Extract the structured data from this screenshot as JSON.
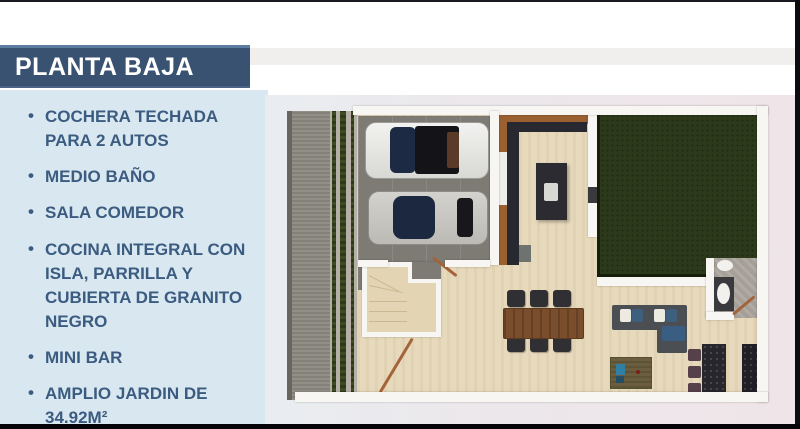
{
  "slide": {
    "title": "PLANTA BAJA",
    "features": [
      "COCHERA TECHADA PARA 2 AUTOS",
      "MEDIO BAÑO",
      "SALA COMEDOR",
      "COCINA INTEGRAL CON ISLA, PARRILLA Y CUBIERTA DE GRANITO NEGRO",
      "MINI BAR",
      "AMPLIO JARDIN DE 34.92M²"
    ]
  },
  "colors": {
    "title_bg": "#3A5272",
    "title_border_top": "#5E7CA2",
    "title_text": "#FFFFFF",
    "panel_bg": "#D9E7F0",
    "feature_text": "#3B5C80",
    "plan_bg_left": "#E9EDF1",
    "plan_bg_right": "#EFE5E9",
    "floor_beige": "#E7D9BB",
    "street_gray": "#8B8880",
    "garage_gray": "#7E7B75",
    "garden_green": "#2C3A1B",
    "wall_white": "#F7F6F2",
    "wood_brown": "#9A6030",
    "granite_black": "#26262C",
    "frame_black": "#0B0B10"
  }
}
